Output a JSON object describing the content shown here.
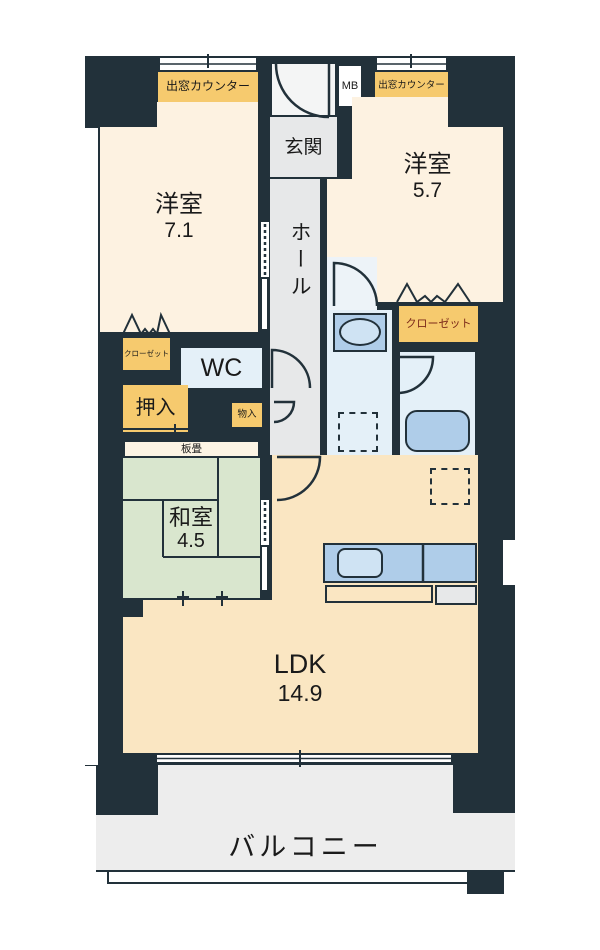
{
  "plan": {
    "rooms": {
      "room1": {
        "label": "洋室",
        "size": "7.1"
      },
      "room2": {
        "label": "洋室",
        "size": "5.7"
      },
      "washitsu": {
        "label": "和室",
        "size": "4.5"
      },
      "ldk": {
        "label": "LDK",
        "size": "14.9"
      },
      "genkan": "玄関",
      "hall": "ホール",
      "wc": "WC",
      "balcony": "バルコニー"
    },
    "storage": {
      "closet_left": "クローゼット",
      "closet_right": "クローゼット",
      "oshiire": "押入",
      "monoire": "物入",
      "itatami": "板畳",
      "mb": "MB",
      "bay_counter_left": "出窓カウンター",
      "bay_counter_right": "出窓カウンター"
    },
    "colors": {
      "wall": "#22313a",
      "western_room_floor": "#fdf2e1",
      "ldk_floor": "#fae6c2",
      "tatami_floor": "#d9e6ce",
      "wet_area_floor": "#e4f0f8",
      "fixture_blue": "#afcde9",
      "storage_yellow": "#f6ca6e",
      "entry_gray": "#e7e8e9",
      "balcony_gray": "#ededed",
      "closet_text_red": "#7c2a1a"
    }
  }
}
